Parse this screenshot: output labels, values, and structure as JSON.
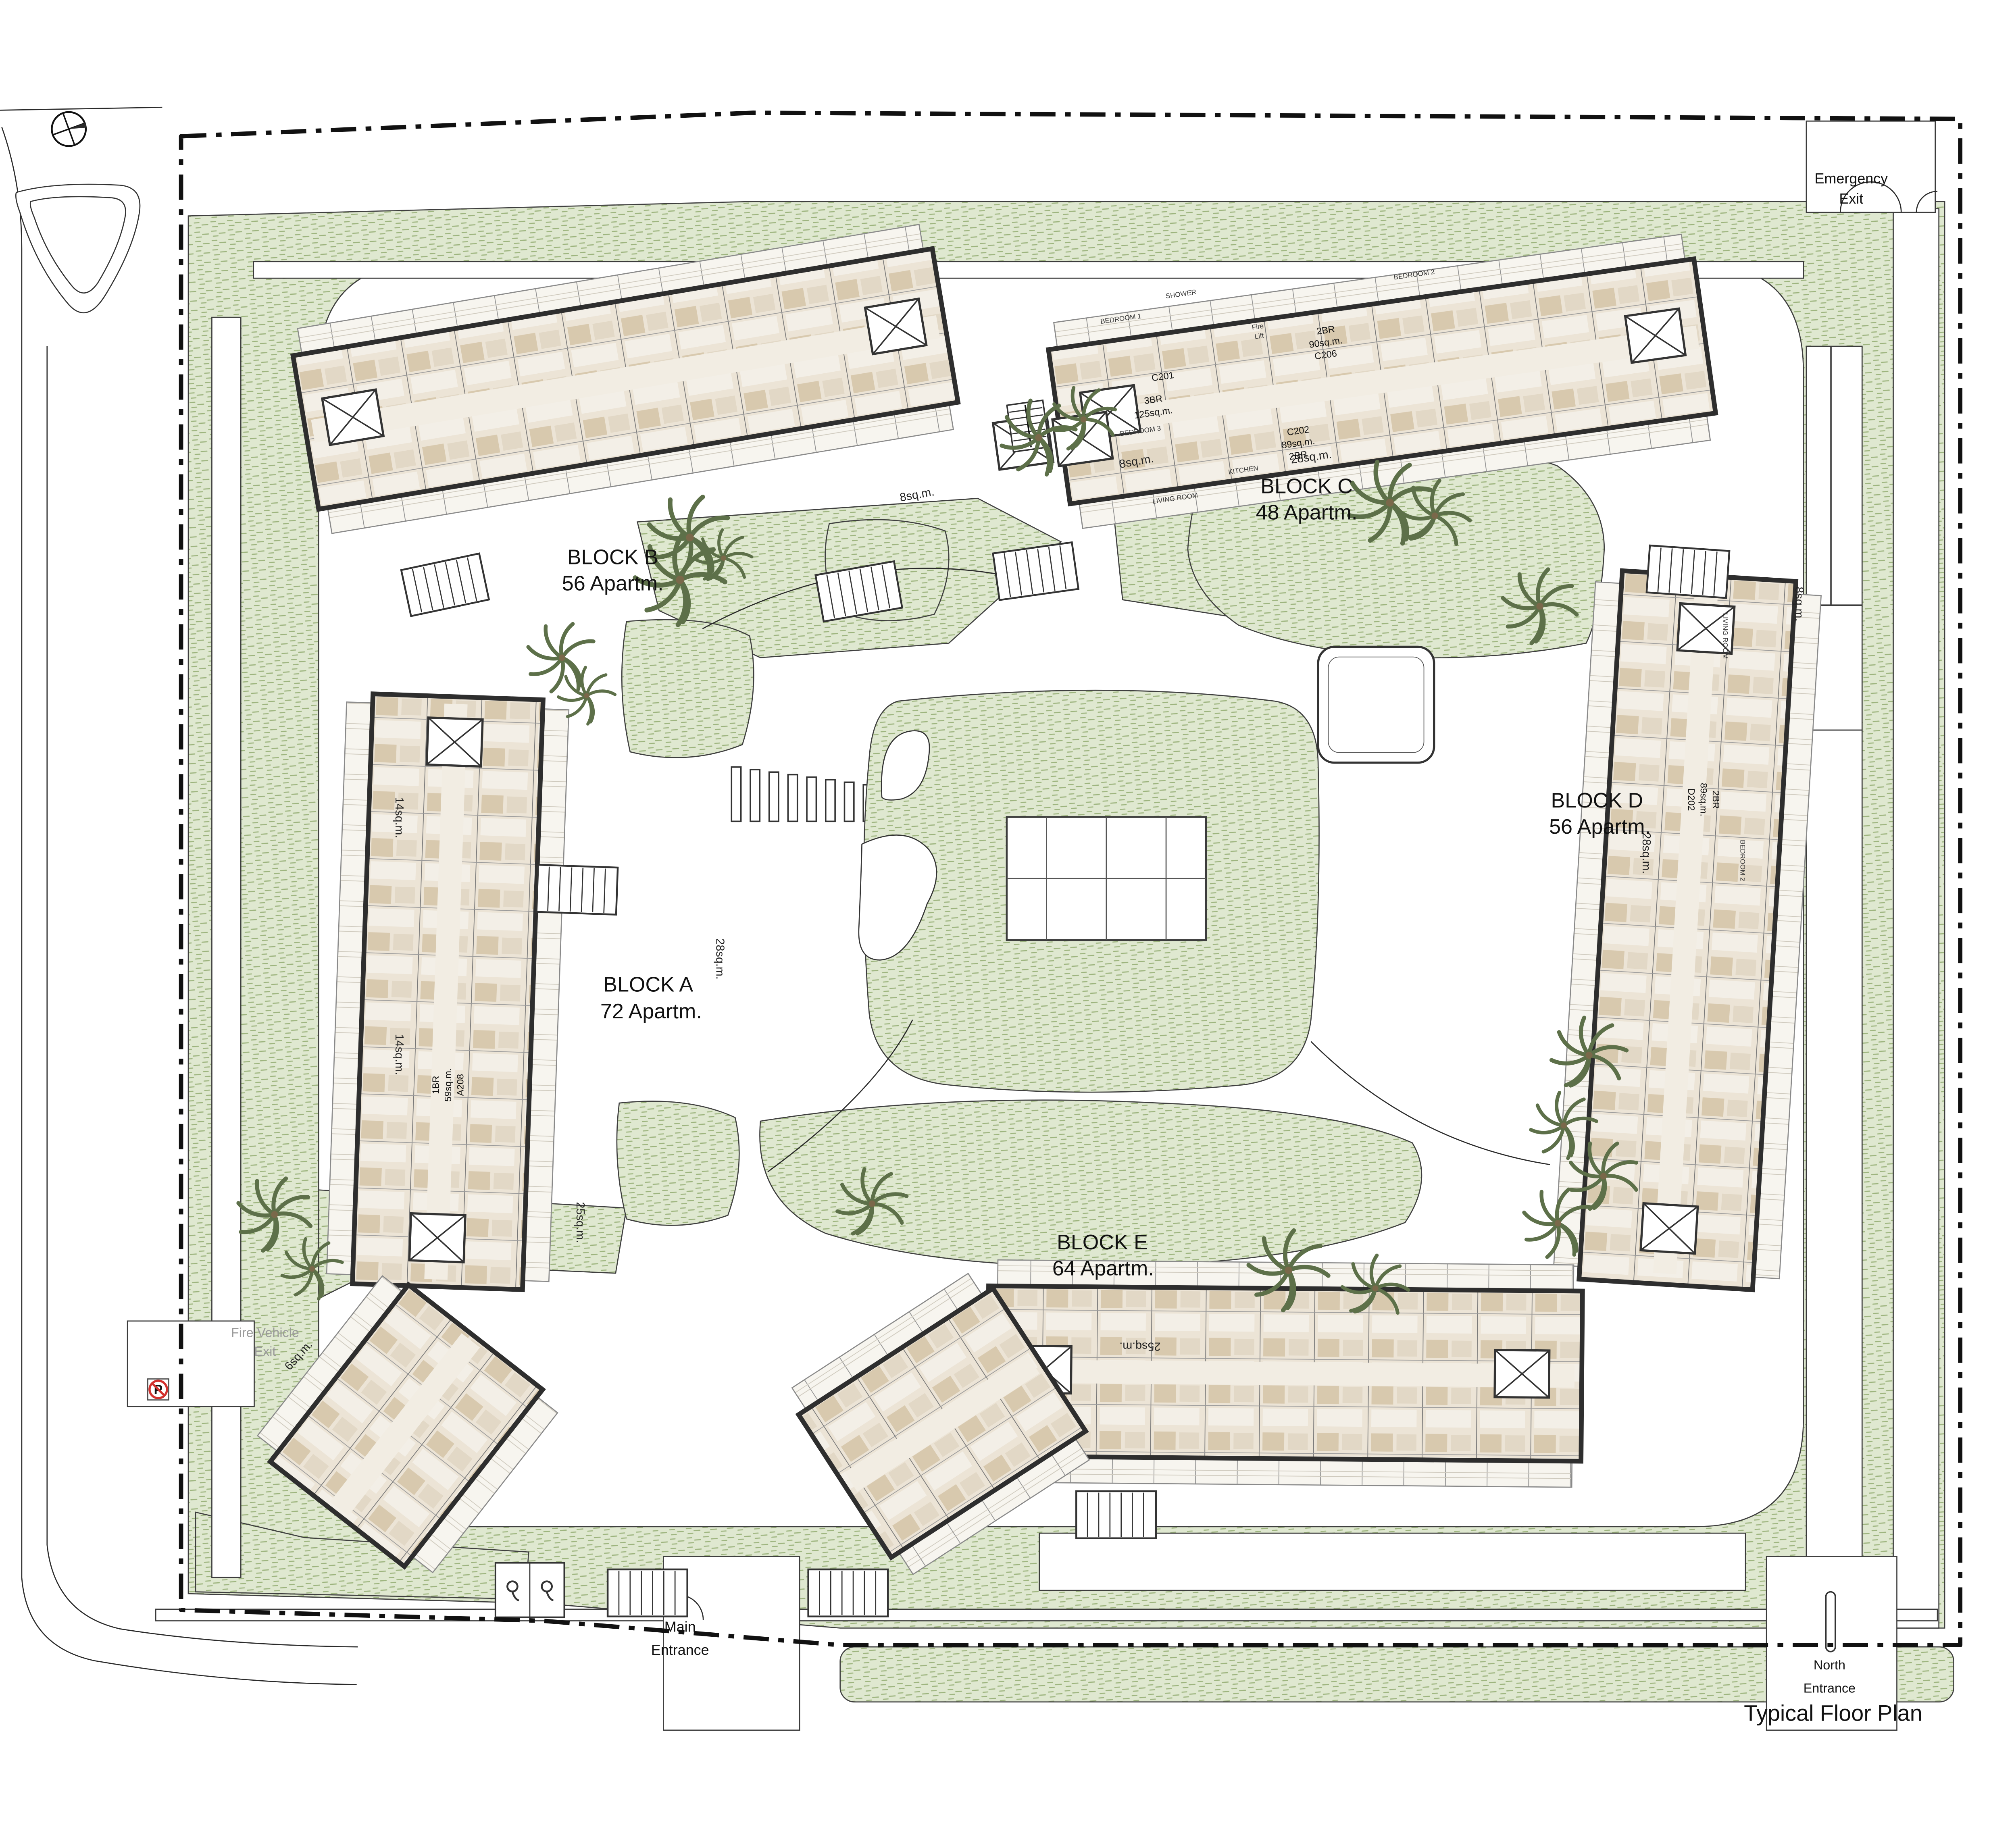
{
  "title": "Typical Floor Plan",
  "site": {
    "blocks": [
      {
        "name": "BLOCK A",
        "apartments": "72 Apartm."
      },
      {
        "name": "BLOCK B",
        "apartments": "56 Apartm."
      },
      {
        "name": "BLOCK C",
        "apartments": "48 Apartm."
      },
      {
        "name": "BLOCK D",
        "apartments": "56 Apartm."
      },
      {
        "name": "BLOCK E",
        "apartments": "64 Apartm."
      }
    ],
    "entrances": {
      "emergency": [
        "Emergency",
        "Exit"
      ],
      "main": [
        "Main",
        "Entrance"
      ],
      "north": [
        "North",
        "Entrance"
      ],
      "fire": [
        "Fire Vehicle",
        "Exit"
      ]
    }
  },
  "area_labels": {
    "sqm28": "28sq.m.",
    "sqm25": "25sq.m.",
    "sqm14": "14sq.m.",
    "sqm8": "8sq.m.",
    "sqm6": "6sq.m."
  },
  "units": {
    "c201": "C201",
    "c202": [
      "C202",
      "89sq.m.",
      "2BR"
    ],
    "c206": [
      "2BR",
      "90sq.m.",
      "C206"
    ],
    "c_3br": [
      "3BR",
      "125sq.m."
    ],
    "a208": [
      "1BR",
      "59sq.m.",
      "A208"
    ],
    "d202": [
      "D202",
      "89sq.m.",
      "2BR"
    ]
  },
  "rooms": {
    "living": "LIVING ROOM",
    "bedroom1": "BEDROOM 1",
    "bedroom2": "BEDROOM 2",
    "bedroom3": "BEDROOM 3",
    "kitchen": "KITCHEN",
    "shower": "SHOWER",
    "fire_lift": [
      "Fire",
      "Lift"
    ]
  },
  "signs": {
    "no_parking": "P"
  },
  "colors": {
    "landscape": "#dfe8d0",
    "landscape_hatch": "#9db47e",
    "wall": "#2e2e2e",
    "room_tint": "#d8c9ae",
    "road_line": "#3c3c3c",
    "boundary": "#111111",
    "no_parking_red": "#d2322e",
    "palm": "#5d7049"
  }
}
